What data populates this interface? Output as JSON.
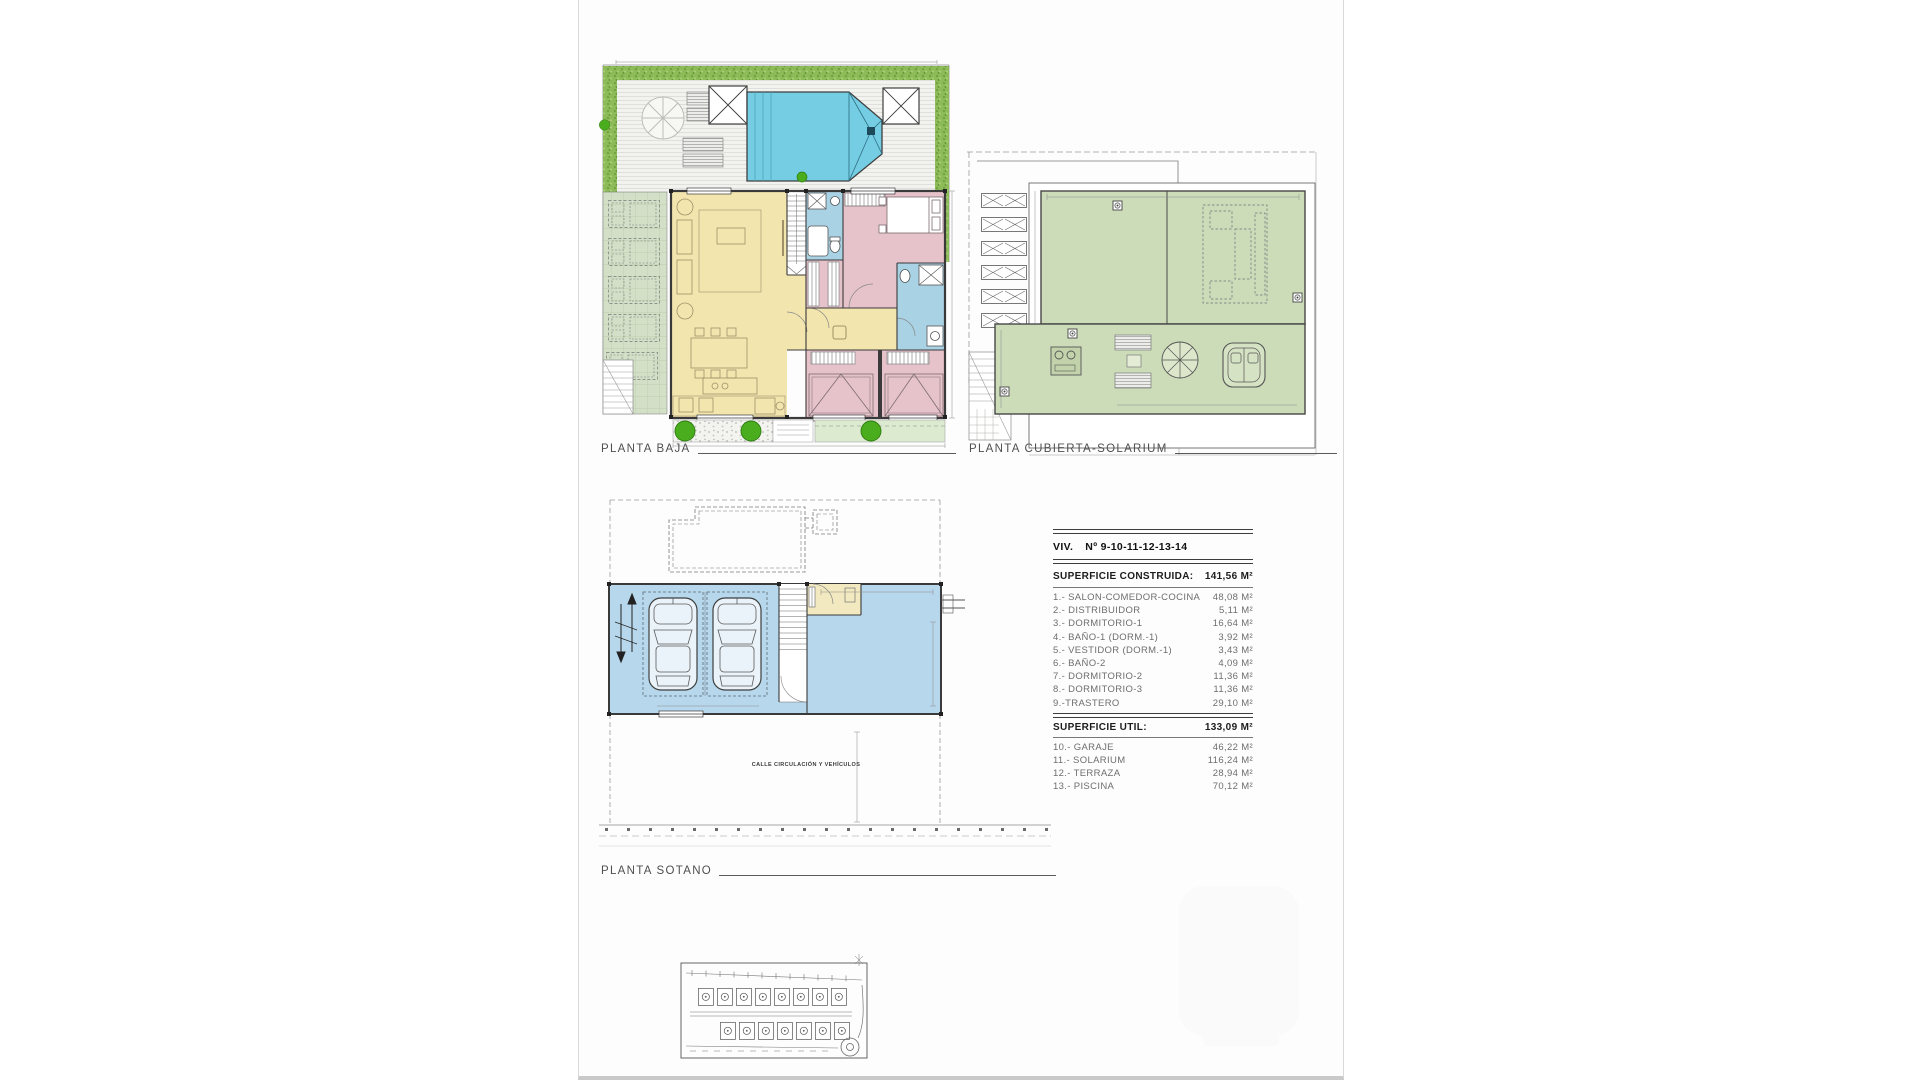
{
  "sheet": {
    "background": "#fdfdfd",
    "border_color": "#d9d9d9"
  },
  "plan_labels": {
    "planta_baja": "PLANTA BAJA",
    "planta_cubierta": "PLANTA CUBIERTA-SOLARIUM",
    "planta_sotano": "PLANTA SOTANO"
  },
  "sotano": {
    "street_label": "CALLE CIRCULACIÓN Y VEHÍCULOS"
  },
  "area_table": {
    "unit_title": "VIV.",
    "unit_numbers": "Nº 9-10-11-12-13-14",
    "built_label": "SUPERFICIE CONSTRUIDA:",
    "built_value": "141,56 M²",
    "built_rows": [
      {
        "label": "1.- SALON-COMEDOR-COCINA",
        "value": "48,08 M²"
      },
      {
        "label": "2.- DISTRIBUIDOR",
        "value": "5,11 M²"
      },
      {
        "label": "3.- DORMITORIO-1",
        "value": "16,64 M²"
      },
      {
        "label": "4.- BAÑO-1 (DORM.-1)",
        "value": "3,92 M²"
      },
      {
        "label": "5.- VESTIDOR (DORM.-1)",
        "value": "3,43 M²"
      },
      {
        "label": "6.- BAÑO-2",
        "value": "4,09 M²"
      },
      {
        "label": "7.- DORMITORIO-2",
        "value": "11,36 M²"
      },
      {
        "label": "8.- DORMITORIO-3",
        "value": "11,36 M²"
      },
      {
        "label": "9.-TRASTERO",
        "value": "29,10 M²"
      }
    ],
    "util_label": "SUPERFICIE UTIL:",
    "util_value": "133,09 M²",
    "util_rows": [
      {
        "label": "10.- GARAJE",
        "value": "46,22 M²"
      },
      {
        "label": "11.- SOLARIUM",
        "value": "116,24 M²"
      },
      {
        "label": "12.- TERRAZA",
        "value": "28,94 M²"
      },
      {
        "label": "13.- PISCINA",
        "value": "70,12 M²"
      }
    ]
  },
  "legend_colors": {
    "salon_yellow": "#f3e5ae",
    "bedroom_pink": "#e6c3cb",
    "bath_blue": "#a9d2e5",
    "pool_blue": "#74cde3",
    "solarium_green": "#ccdcb9",
    "terrace_green": "#d3e0c7",
    "hedge_green": "#8cbb58",
    "bush_green": "#49ad1d",
    "garage_blue": "#b7d8ec",
    "wall_line": "#3a3a3a"
  }
}
